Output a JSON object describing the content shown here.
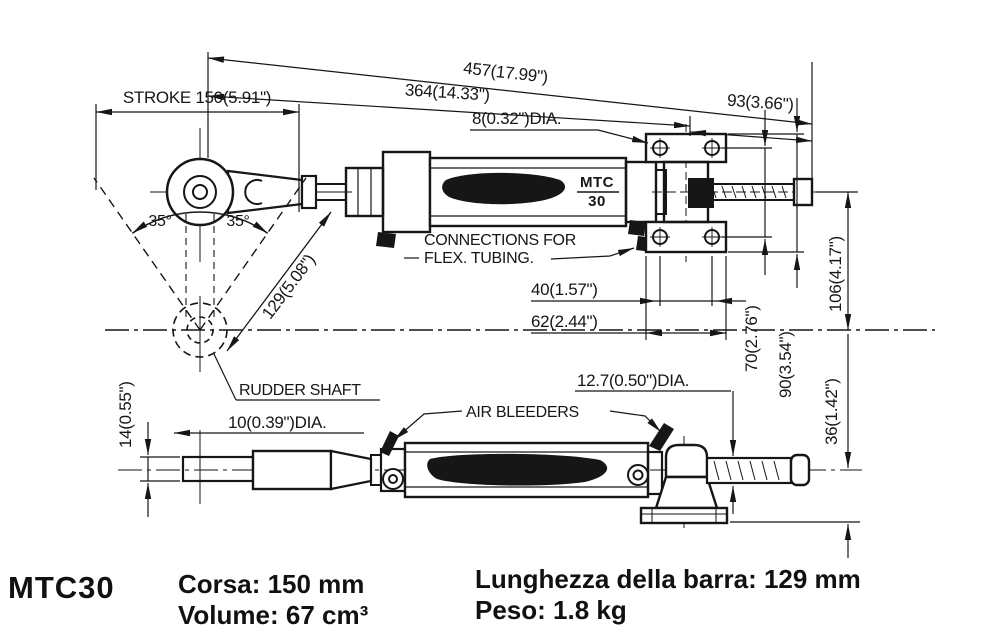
{
  "drawing": {
    "colors": {
      "ink": "#161616",
      "paper": "#ffffff"
    },
    "labels": {
      "stroke": "STROKE 150(5.91\")",
      "overall_length": "457(17.99\")",
      "eye_to_bracket": "364(14.33\")",
      "bracket_to_rod_end": "93(3.66\")",
      "mount_hole_dia": "8(0.32\")DIA.",
      "connections_line1": "CONNECTIONS FOR",
      "connections_line2": "FLEX. TUBING.",
      "hole_spacing_horizontal": "40(1.57\")",
      "bracket_width": "62(2.44\")",
      "hole_spacing_vertical": "70(2.76\")",
      "bracket_height": "90(3.54\")",
      "centerline_offset": "106(4.17\")",
      "base_height": "36(1.42\")",
      "angle_left": "35°",
      "angle_right": "35°",
      "tiller_radius": "129(5.08\")",
      "rudder_shaft": "RUDDER SHAFT",
      "rod_end_hole_dia": "10(0.39\")DIA.",
      "tang_thickness": "14(0.55\")",
      "rod_dia": "12.7(0.50\")DIA.",
      "air_bleeders": "AIR BLEEDERS",
      "model_top": "MTC",
      "model_bottom": "30"
    }
  },
  "specs": {
    "model": "MTC30",
    "col1": [
      "Corsa: 150 mm",
      "Volume: 67 cm³"
    ],
    "col2": [
      "Lunghezza della barra: 129 mm",
      "Peso: 1.8 kg"
    ]
  }
}
